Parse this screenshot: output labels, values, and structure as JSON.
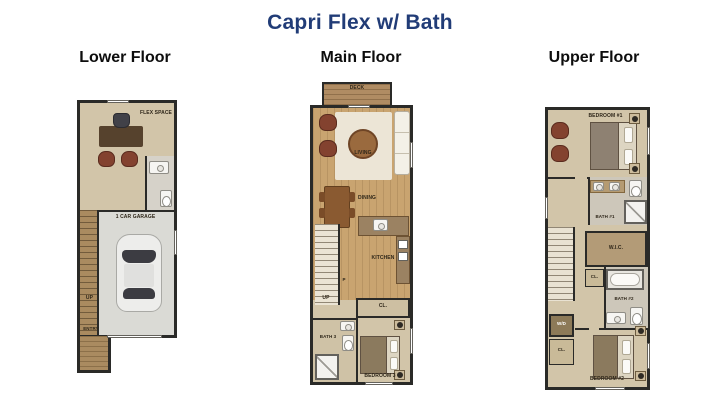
{
  "title": "Capri Flex w/ Bath",
  "colors": {
    "title_navy": "#213c77",
    "heading_black": "#0d0d0d",
    "wall": "#2a2a28",
    "wood_floor": "#c9a470",
    "tan_floor": "#d2c5a9",
    "stair_wood": "#aa8b60",
    "garage_floor": "#dadad5",
    "bath_floor": "#cdc7ba",
    "accent_chair": "#83422f",
    "counter_brown": "#9b8262"
  },
  "floors": [
    {
      "name": "Lower Floor",
      "labels": {
        "flex": "FLEX SPACE",
        "garage": "1 CAR GARAGE",
        "up": "UP",
        "entry": "ENTRY"
      }
    },
    {
      "name": "Main Floor",
      "labels": {
        "deck": "DECK",
        "living": "LIVING",
        "dining": "DINING",
        "kitchen": "KITCHEN",
        "pantry": "P",
        "up": "UP",
        "closet": "CL.",
        "bath": "BATH 3",
        "bedroom": "BEDROOM 3"
      }
    },
    {
      "name": "Upper Floor",
      "labels": {
        "bedroom1": "BEDROOM #1",
        "bath1": "BATH #1",
        "wic": "W.I.C.",
        "closet_hall": "CL.",
        "bath2": "BATH #2",
        "wd": "W/D",
        "closet_left": "CL.",
        "bedroom2": "BEDROOM #2"
      }
    }
  ]
}
